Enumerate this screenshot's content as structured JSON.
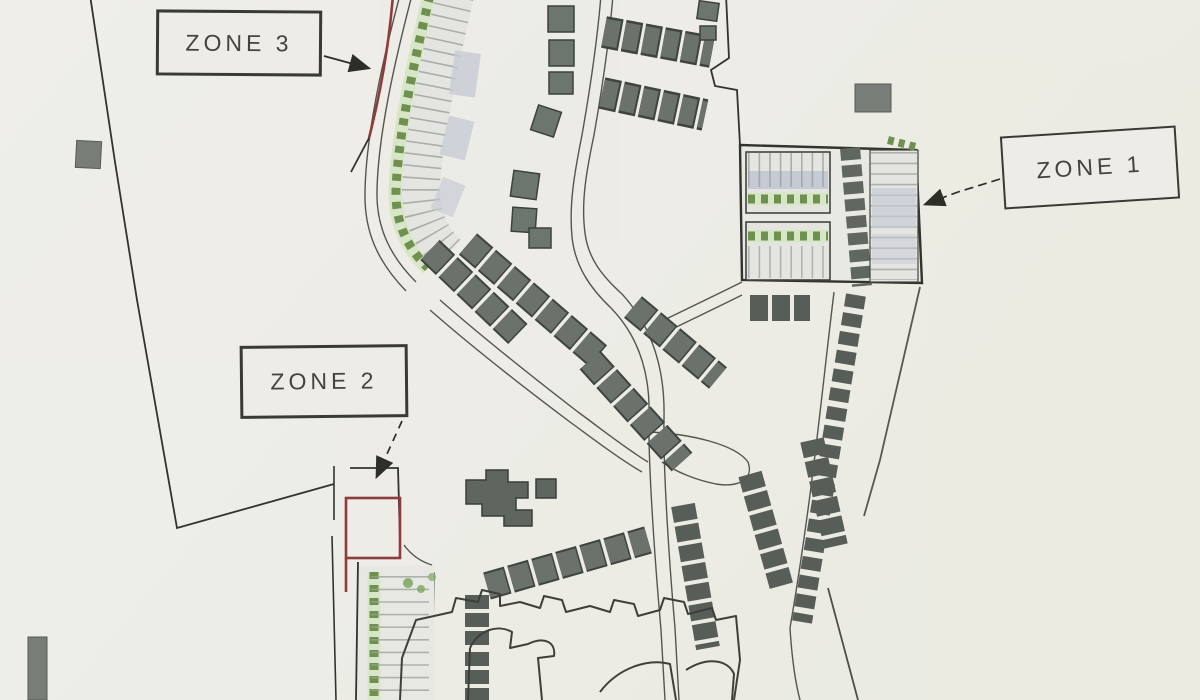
{
  "labels": {
    "zone1": "ZONE 1",
    "zone2": "ZONE 2",
    "zone3": "ZONE 3"
  },
  "colors": {
    "paper": "#edece6",
    "ink": "#3a3a34",
    "zone_red": "#8e3b3b",
    "building": "#69716a",
    "building_dark": "#3e443e",
    "green": "#6f9150",
    "green_light": "#d8e6c8",
    "stall_band": "#e4e5e0",
    "stall_tick": "#9aa09a",
    "lavender": "#c6cad5"
  }
}
